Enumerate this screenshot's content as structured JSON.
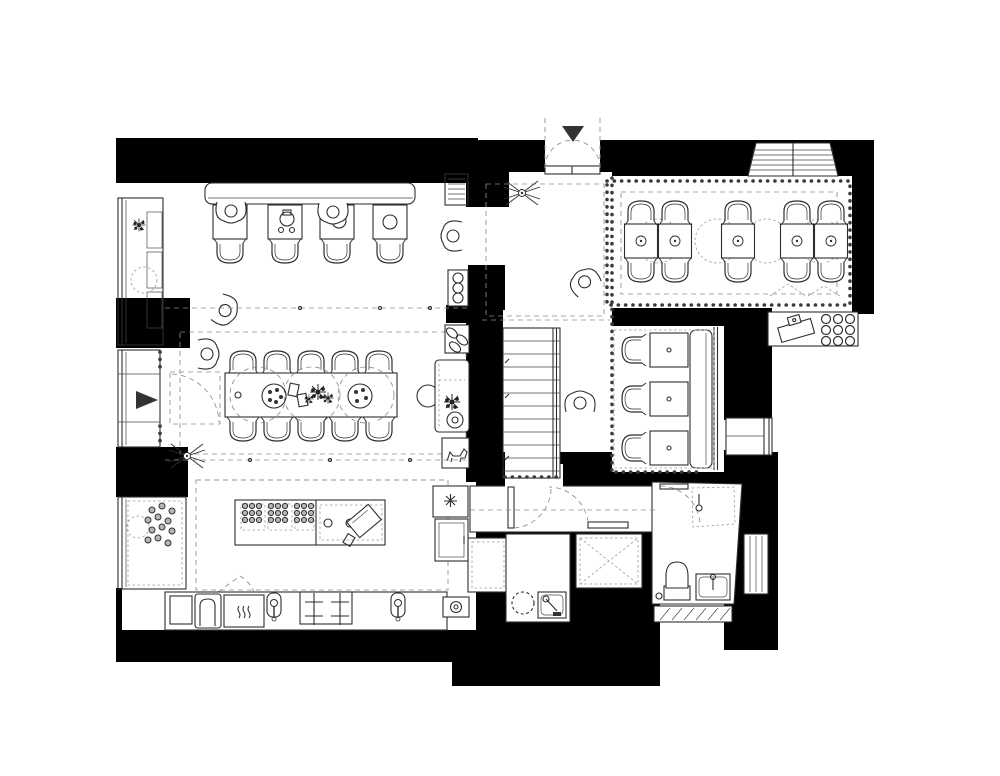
{
  "palette": {
    "background": "#ffffff",
    "wall_fill": "#000000",
    "furniture_line": "#2e2e2e",
    "dashed_guide_line": "#8c8c8c"
  },
  "plan": {
    "type": "restaurant floor plan, top-down, black-and-white line drawing",
    "entrances": {
      "main_entrance": {
        "marker": "solid-triangle-arrow",
        "direction": "down",
        "doors": "double swing"
      },
      "side_entrance": {
        "marker": "solid-triangle-arrow",
        "direction": "right",
        "doors": "single swing"
      }
    },
    "rooms": [
      {
        "id": "lounge",
        "position": "top-left",
        "furniture": {
          "wall_bench": 1,
          "square_tables": 4,
          "chairs": 4,
          "window_seat_sections": 3,
          "plant": 1,
          "wall_grille": 1
        }
      },
      {
        "id": "entrance-hall",
        "position": "top-center",
        "features": [
          "ceiling-fan",
          "person-figure",
          "beaded-curtain-divider"
        ]
      },
      {
        "id": "booth-dining-room",
        "position": "top-right",
        "furniture": {
          "two_seat_tables": 5,
          "booth_chairs": 10
        },
        "features": [
          "scalloped-curtain-border",
          "bay-window",
          "dashed-lamp-ellipses"
        ]
      },
      {
        "id": "host-counter",
        "position": "right-middle",
        "furniture": {
          "cash_register": 1,
          "glass_rack_circles": 9
        }
      },
      {
        "id": "communal-dining-room",
        "position": "middle-left",
        "furniture": {
          "long_table": 1,
          "chairs": 10,
          "dashed_place_circles": 3,
          "flower_centerpiece": 1,
          "dotted_plates": 2,
          "cups": 2,
          "ceiling_fan": 1,
          "window_with_curtains": 1
        }
      },
      {
        "id": "stair-hall",
        "position": "center",
        "features": [
          "staircase",
          "person-figure"
        ],
        "stair_treads": 11
      },
      {
        "id": "banquette-nook",
        "position": "center-right",
        "furniture": {
          "square_tables": 3,
          "chairs": 3,
          "wall_bench": 1,
          "window": 1
        }
      },
      {
        "id": "kitchen",
        "position": "bottom-left",
        "furniture": {
          "island": 1,
          "food_trays": 6,
          "cutting_board": 1,
          "big_sink": 1,
          "warming_tray": 1,
          "faucets": 2,
          "stove_burners": 4,
          "window_bay_with_berries": 1
        },
        "pass_counter_items": [
          "appliance-3-circles",
          "egg-tray",
          "plant-stand",
          "stool",
          "dog-figure",
          "asterisk-unit",
          "cabinet",
          "outlet-box",
          "wall-grille"
        ]
      },
      {
        "id": "hallway",
        "position": "bottom-center",
        "doors": 2
      },
      {
        "id": "wc",
        "position": "bottom-center",
        "fixtures": [
          "round-basin",
          "sink-with-faucet"
        ]
      },
      {
        "id": "shaft",
        "position": "bottom-center",
        "symbol": "dashed-box-with-X"
      },
      {
        "id": "bathroom",
        "position": "bottom-right",
        "fixtures": [
          "toilet",
          "shower-dashed",
          "sink",
          "hatched-threshold",
          "radiator"
        ]
      }
    ],
    "people_count": 7,
    "ceiling_fans": 2
  }
}
